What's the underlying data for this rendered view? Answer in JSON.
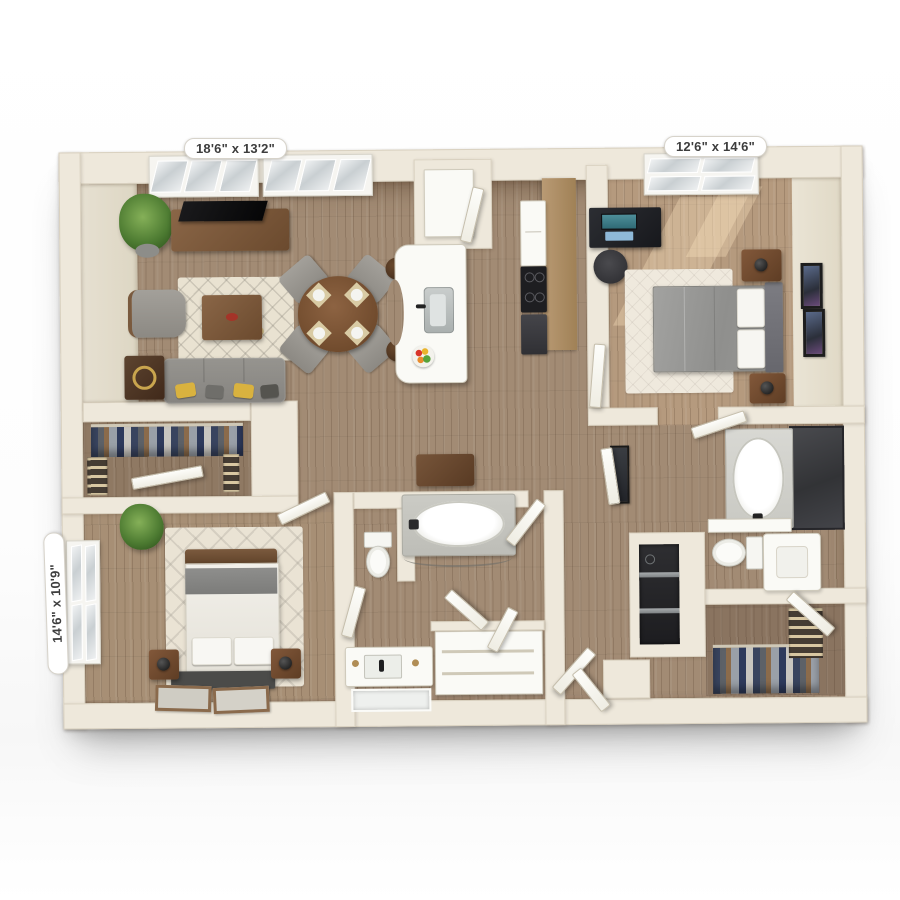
{
  "floor_plan": {
    "dimension_labels": [
      {
        "room": "living-dining-area",
        "text": "18'6\" x 13'2\"",
        "position": "top-left"
      },
      {
        "room": "bedroom-right",
        "text": "12'6\" x 14'6\"",
        "position": "top-right"
      },
      {
        "room": "bedroom-left",
        "text": "14'6\" x 10'9\"",
        "position": "left-side-vertical"
      }
    ],
    "palette": {
      "wall_cream": "#eee8db",
      "floor_wood": "#a28b74",
      "floor_wood_light": "#b59a7e",
      "rug_cream": "#e9e2d1",
      "sofa_gray": "#8f8d88",
      "accent_yellow": "#d9b23f",
      "furniture_wood": "#7b5a3c",
      "fixture_white": "#fafaf6",
      "marble_dark": "#3e3f42",
      "appliance_dark": "#2c2c2e",
      "plant_green": "#4c7a31"
    }
  }
}
